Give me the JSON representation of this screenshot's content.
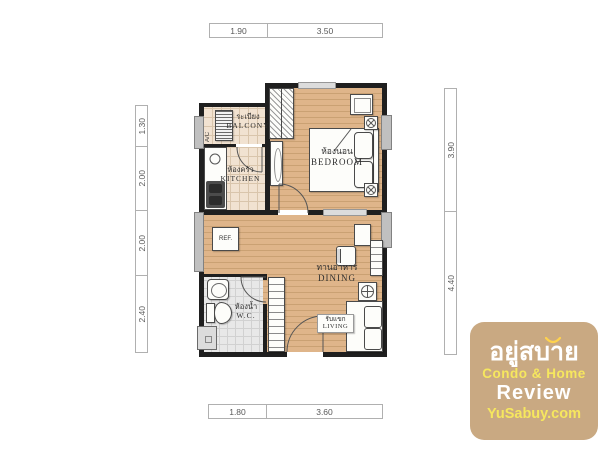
{
  "dimensions": {
    "top": [
      "1.90",
      "3.50"
    ],
    "bottom": [
      "1.80",
      "3.60"
    ],
    "left": [
      "1.30",
      "2.00",
      "2.00",
      "2.40"
    ],
    "right": [
      "3.90",
      "4.40"
    ]
  },
  "rooms": {
    "balcony": {
      "thai": "ระเบียง",
      "en": "BALCONY"
    },
    "kitchen": {
      "thai": "ห้องครัว",
      "en": "KITCHEN"
    },
    "bedroom": {
      "thai": "ห้องนอน",
      "en": "BEDROOM"
    },
    "dining": {
      "thai": "ทานอาหาร",
      "en": "DINING"
    },
    "wc": {
      "thai": "ห้องน้ำ",
      "en": "W.C."
    },
    "living": {
      "thai": "รับแขก",
      "en": "LIVING"
    }
  },
  "fixtures": {
    "refrigerator": "REF.",
    "air_conditioner": "A/C"
  },
  "watermark": {
    "logo_thai": "อยู่สบาย",
    "line1": "Condo & Home",
    "line2": "Review",
    "line3": "YuSabuy.com",
    "box_color": "#c6a47b",
    "yellow": "#f6e75e",
    "white": "#ffffff"
  },
  "colors": {
    "wall": "#1f1f1f",
    "wood_floor": "#dfb58a",
    "tile_floor": "#f1e2d1",
    "wc_floor": "#e8e8e8",
    "window": "#c0c0c0"
  }
}
